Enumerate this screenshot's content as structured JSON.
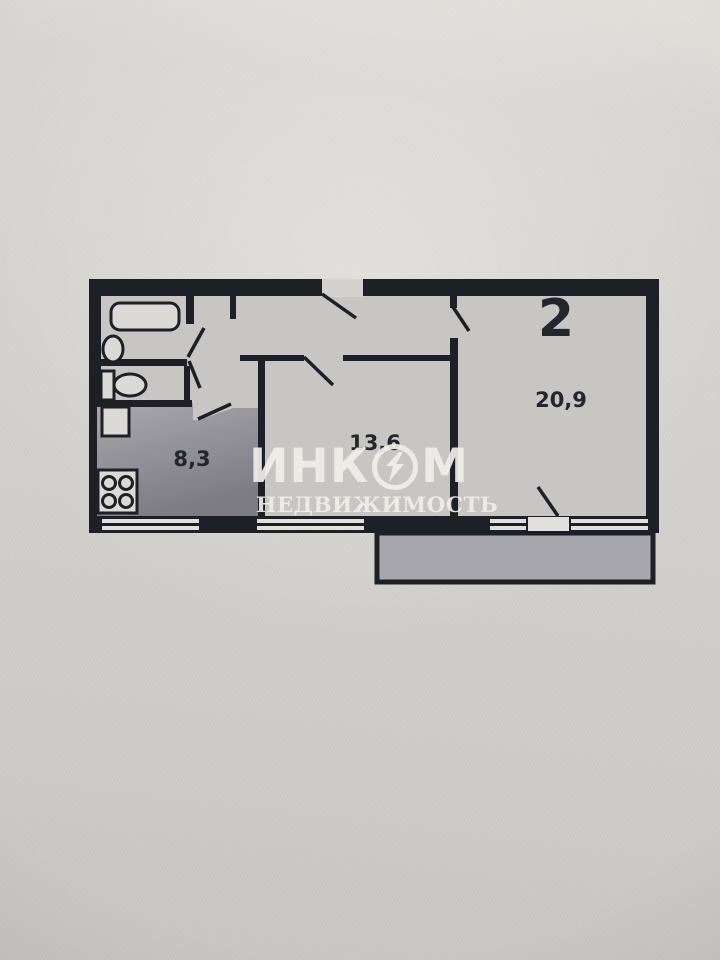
{
  "floorplan": {
    "flat_label": "2",
    "rooms": [
      {
        "id": "kitchen",
        "area_label": "8,3"
      },
      {
        "id": "room-13-6",
        "area_label": "13,6"
      },
      {
        "id": "room-20-9",
        "area_label": "20,9"
      }
    ],
    "fixtures": [
      "bathtub-icon",
      "sink-icon",
      "toilet-icon",
      "fridge-icon",
      "stove-icon"
    ],
    "colors": {
      "wall": "#1e2028",
      "room_fill": "#c7c6c2",
      "kitchen_fill_light": "#a9a8ae",
      "kitchen_fill_dark": "#7d7c84",
      "balcony_fill": "#a7a6ac",
      "window_stripe": "#e2e0dc",
      "paper": "#d4d2ce",
      "label_text": "#24262d"
    }
  },
  "watermark": {
    "brand": "ИНКОМ",
    "brand_part1": "ИНК",
    "brand_part2": "М",
    "subtitle": "НЕДВИЖИМОСТЬ",
    "logo": "lightning-in-circle-icon",
    "color": "#f0eee9"
  }
}
